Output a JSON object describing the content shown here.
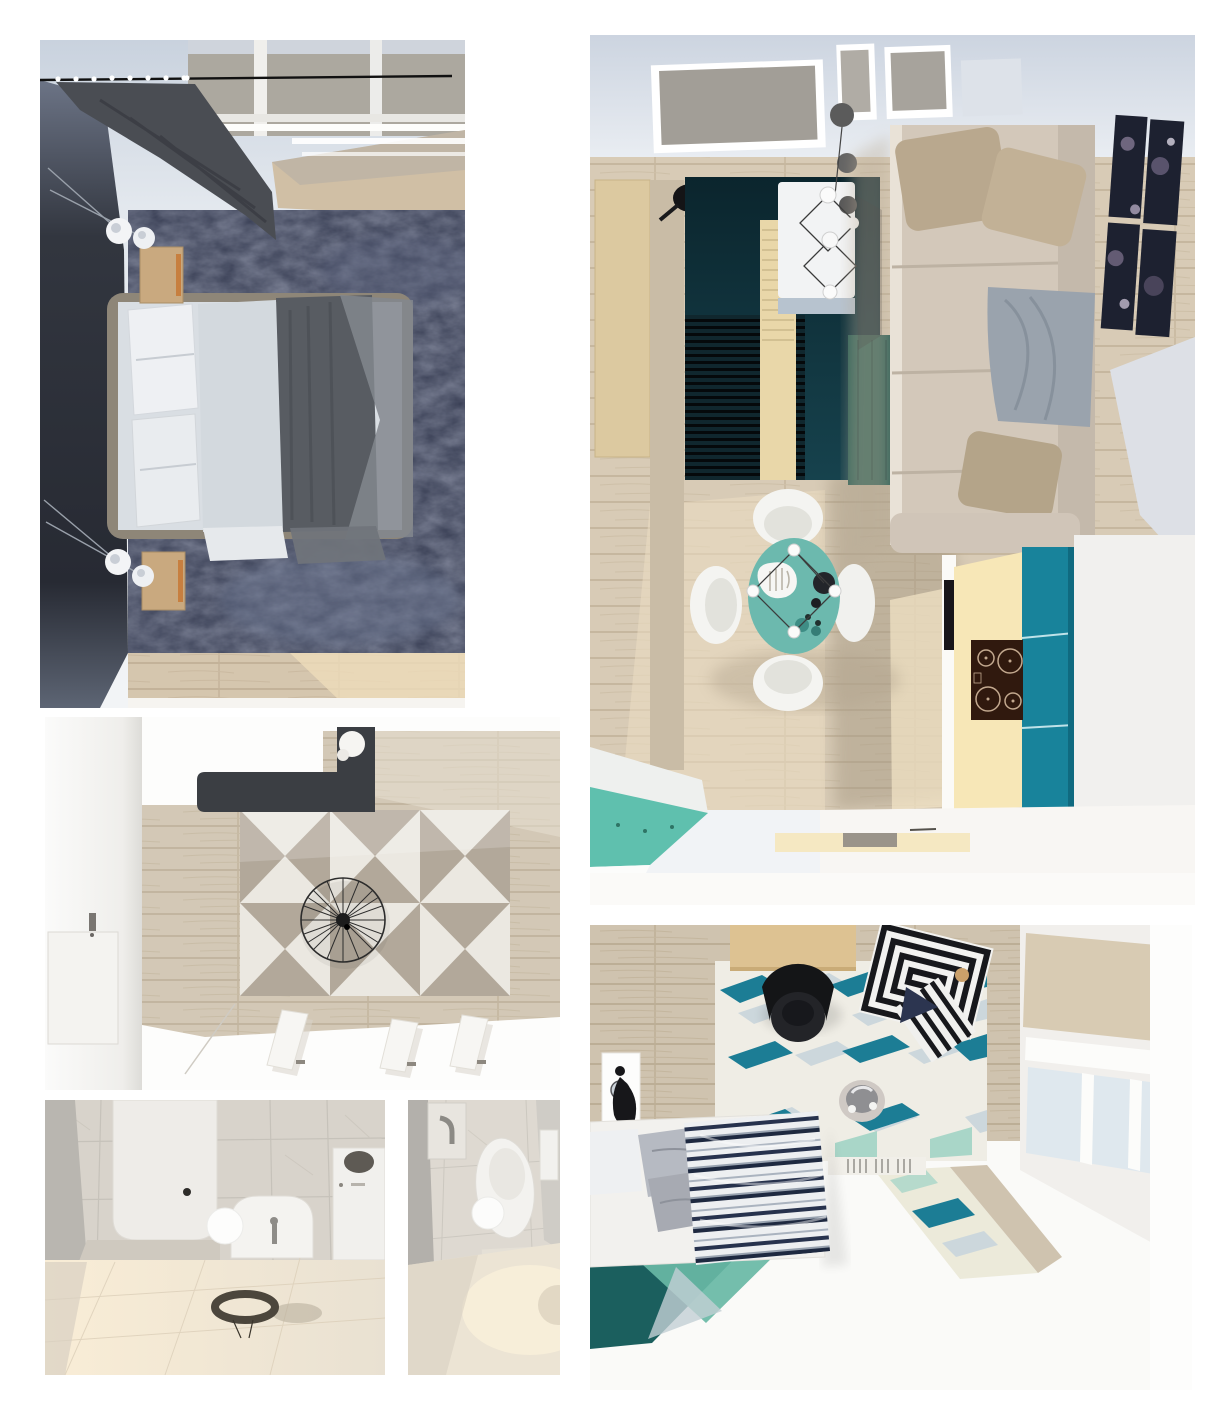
{
  "page": {
    "background": "#ffffff",
    "description": "Collage of six top-down 3D interior renders of a small apartment"
  },
  "palette": {
    "wall_light": "#d3d9e3",
    "wood_floor": "#d6c9b4",
    "curtain_gray": "#4a4d53",
    "bedroom_rug_navy": "#363c52",
    "living_rug_teal": "#0f333d",
    "living_rug_green": "#2e6157",
    "runner_beige": "#e9d7a9",
    "sofa_beige": "#d3c8ba",
    "dining_table_teal": "#6cb9ae",
    "chair_white": "#f4f4f1",
    "counter_cream": "#f7e7b7",
    "kitchen_teal": "#18839b",
    "cooktop_brown": "#30190e",
    "kitchen_floor_teal": "#5fc0ae",
    "art_navy": "#1d2130",
    "hall_tile_gray": "#b2a89a",
    "hall_tile_white": "#ebe8e1",
    "wardrobe_charcoal": "#3b3e43",
    "marble_light": "#d8d3cb",
    "tile_cube_teal": "#1c7d95",
    "tile_cube_pale": "#ccd7dc",
    "tile_cube_aqua": "#a9d6c8",
    "duvet_navy": "#27324d",
    "bed2_rug_teal": "#1b5f5e",
    "bed2_rug_mint": "#68b9a5",
    "desk_wood": "#ddc292",
    "pouf_black": "#17181c"
  },
  "panels": [
    {
      "id": "master-bedroom",
      "name": "master bedroom top view"
    },
    {
      "id": "living-room-kitchen",
      "name": "living room and kitchen top view"
    },
    {
      "id": "hallway",
      "name": "hallway top view"
    },
    {
      "id": "bathroom",
      "name": "bathroom top view"
    },
    {
      "id": "wc",
      "name": "wc top view"
    },
    {
      "id": "second-bedroom",
      "name": "second bedroom top view"
    }
  ]
}
